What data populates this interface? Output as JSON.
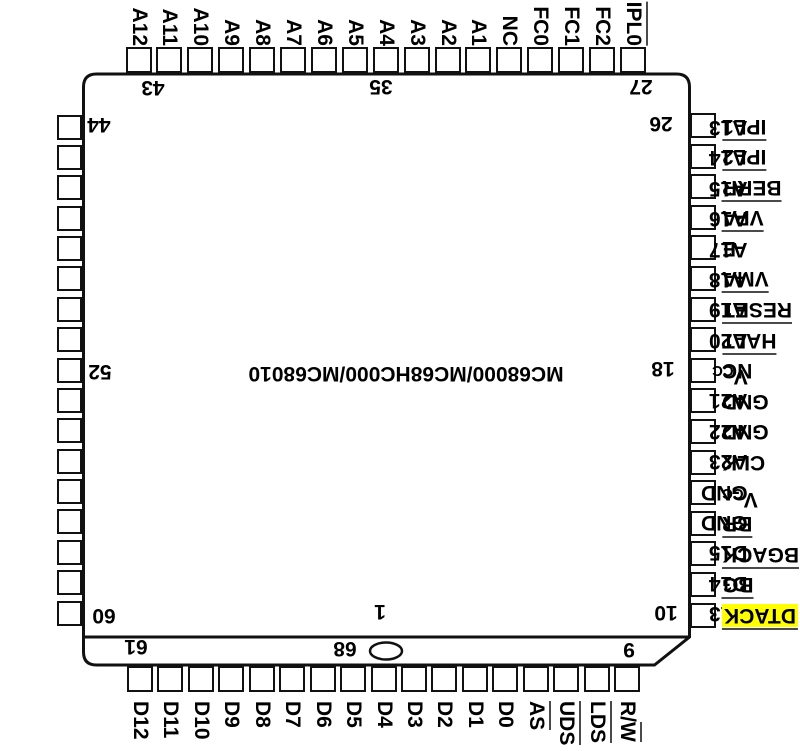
{
  "title": "MC68000/MC68HC000/MC68010",
  "colors": {
    "highlight": "#ffff00",
    "ink": "#111111"
  },
  "pins": {
    "top": [
      {
        "label": "A12"
      },
      {
        "label": "A11"
      },
      {
        "label": "A10"
      },
      {
        "label": "A9"
      },
      {
        "label": "A8"
      },
      {
        "label": "A7"
      },
      {
        "label": "A6"
      },
      {
        "label": "A5"
      },
      {
        "label": "A4"
      },
      {
        "label": "A3"
      },
      {
        "label": "A2"
      },
      {
        "label": "A1"
      },
      {
        "label": "NC"
      },
      {
        "label": "FC0"
      },
      {
        "label": "FC1"
      },
      {
        "label": "FC2"
      },
      {
        "label": "IPL0",
        "overline": true
      }
    ],
    "left": [
      {
        "label": "A13"
      },
      {
        "label": "A14"
      },
      {
        "label": "A15"
      },
      {
        "label": "A16"
      },
      {
        "label": "A17"
      },
      {
        "label": "A18"
      },
      {
        "label": "A19"
      },
      {
        "label": "A20"
      },
      {
        "label": "VCC",
        "sub": "CC"
      },
      {
        "label": "A21"
      },
      {
        "label": "A22"
      },
      {
        "label": "A23"
      },
      {
        "label": "GND"
      },
      {
        "label": "GND"
      },
      {
        "label": "D15"
      },
      {
        "label": "D14"
      },
      {
        "label": "D13"
      }
    ],
    "right": [
      {
        "label": "IPL1",
        "overline": true
      },
      {
        "label": "IPL2",
        "overline": true
      },
      {
        "label": "BERR",
        "overline": true
      },
      {
        "label": "VPA",
        "overline": true
      },
      {
        "label": "E"
      },
      {
        "label": "VMA",
        "overline": true
      },
      {
        "label": "RESET",
        "overline": true
      },
      {
        "label": "HALT",
        "overline": true
      },
      {
        "label": "NC"
      },
      {
        "label": "GND"
      },
      {
        "label": "GND"
      },
      {
        "label": "CLK"
      },
      {
        "label": "VCC",
        "sub": "CC"
      },
      {
        "label": "BR",
        "overline": true
      },
      {
        "label": "BGACK",
        "overline": true
      },
      {
        "label": "BG",
        "overline": true
      },
      {
        "label": "DTACK",
        "overline": true,
        "highlight": true
      }
    ],
    "bottom": [
      {
        "label": "D12"
      },
      {
        "label": "D11"
      },
      {
        "label": "D10"
      },
      {
        "label": "D9"
      },
      {
        "label": "D8"
      },
      {
        "label": "D7"
      },
      {
        "label": "D6"
      },
      {
        "label": "D5"
      },
      {
        "label": "D4"
      },
      {
        "label": "D3"
      },
      {
        "label": "D2"
      },
      {
        "label": "D1"
      },
      {
        "label": "D0"
      },
      {
        "label": "AS",
        "overline": true
      },
      {
        "label": "UDS",
        "overline": true
      },
      {
        "label": "LDS",
        "overline": true
      },
      {
        "label": "R/W",
        "overline": "W"
      }
    ]
  },
  "pin_numbers": [
    {
      "text": "43",
      "anchor": "top-left"
    },
    {
      "text": "35",
      "anchor": "top-center"
    },
    {
      "text": "27",
      "anchor": "top-right"
    },
    {
      "text": "44",
      "anchor": "left-top"
    },
    {
      "text": "52",
      "anchor": "left-middle"
    },
    {
      "text": "60",
      "anchor": "left-bottom"
    },
    {
      "text": "26",
      "anchor": "right-top"
    },
    {
      "text": "18",
      "anchor": "right-middle"
    },
    {
      "text": "10",
      "anchor": "right-bottom"
    },
    {
      "text": "61",
      "anchor": "bottom-left"
    },
    {
      "text": "68",
      "anchor": "bottom-center"
    },
    {
      "text": "9",
      "anchor": "bottom-right"
    },
    {
      "text": "1",
      "anchor": "pin-one"
    }
  ]
}
